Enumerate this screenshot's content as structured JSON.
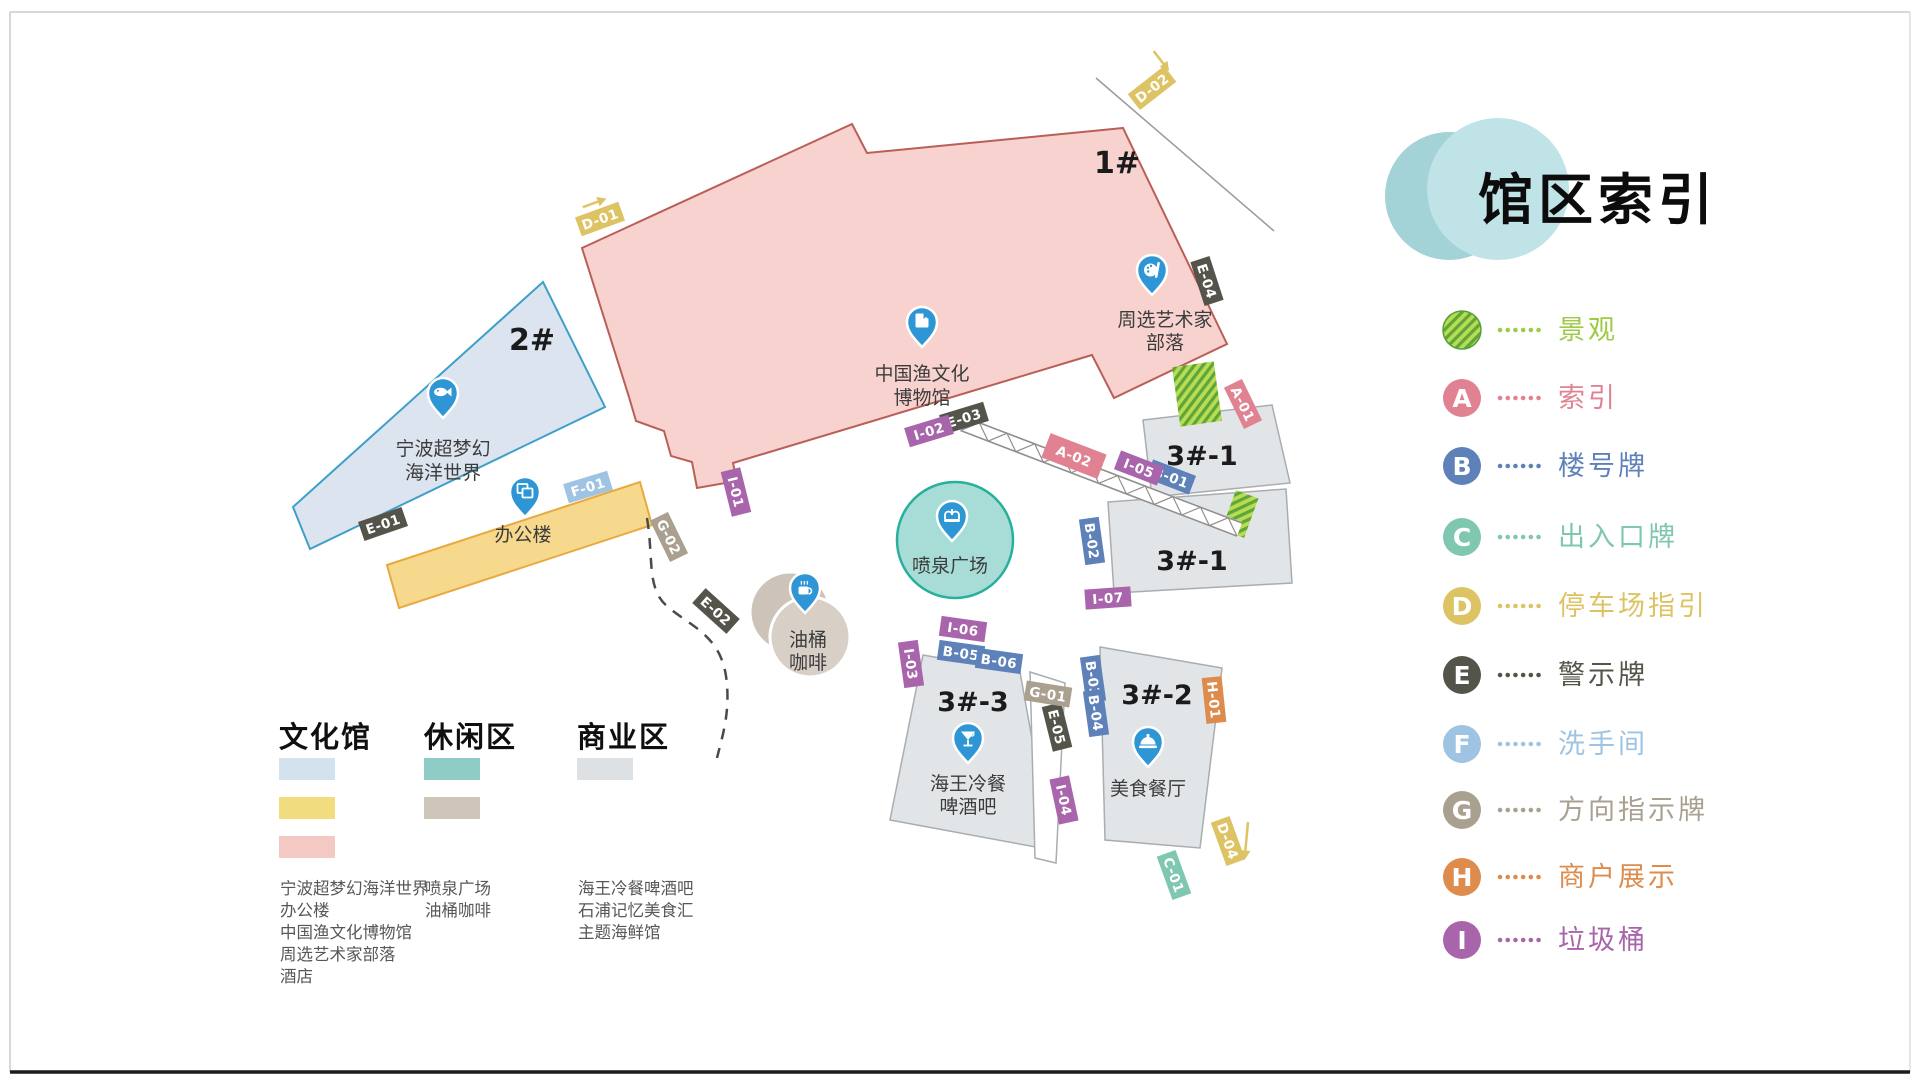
{
  "title": "馆区索引",
  "legend": {
    "items": [
      {
        "letter": "",
        "label": "景观",
        "color": "#9ecb45"
      },
      {
        "letter": "A",
        "label": "索引",
        "color": "#e08292"
      },
      {
        "letter": "B",
        "label": "楼号牌",
        "color": "#5e81ba"
      },
      {
        "letter": "C",
        "label": "出入口牌",
        "color": "#7fc7b0"
      },
      {
        "letter": "D",
        "label": "停车场指引",
        "color": "#ddc364"
      },
      {
        "letter": "E",
        "label": "警示牌",
        "color": "#55544a"
      },
      {
        "letter": "F",
        "label": "洗手间",
        "color": "#9fc3e3"
      },
      {
        "letter": "G",
        "label": "方向指示牌",
        "color": "#a9a090"
      },
      {
        "letter": "H",
        "label": "商户展示",
        "color": "#dd8c4d"
      },
      {
        "letter": "I",
        "label": "垃圾桶",
        "color": "#a965ab"
      }
    ]
  },
  "categories": [
    {
      "title": "文化馆",
      "swatches": [
        "#d4e2ee",
        "#f2dc80",
        "#f5c9c3"
      ],
      "items": [
        "宁波超梦幻海洋世界",
        "办公楼",
        "中国渔文化博物馆",
        "周选艺术家部落",
        "酒店"
      ]
    },
    {
      "title": "休闲区",
      "swatches": [
        "#8fccc6",
        "#cfc5b8"
      ],
      "items": [
        "喷泉广场",
        "油桶咖啡"
      ]
    },
    {
      "title": "商业区",
      "swatches": [
        "#dde1e3"
      ],
      "items": [
        "海王冷餐啤酒吧",
        "石浦记忆美食汇",
        "主题海鲜馆"
      ]
    }
  ],
  "map": {
    "buildings": {
      "b1": {
        "number": "1#",
        "name1": "中国渔文化",
        "name2": "博物馆",
        "artist1": "周选艺术家",
        "artist2": "部落"
      },
      "b2": {
        "number": "2#",
        "name1": "宁波超梦幻",
        "name2": "海洋世界"
      },
      "office": {
        "name": "办公楼"
      },
      "b31_up": {
        "number": "3#-1"
      },
      "b31_lo": {
        "number": "3#-1"
      },
      "b32": {
        "number": "3#-2",
        "name": "美食餐厅"
      },
      "b33": {
        "number": "3#-3",
        "name1": "海王冷餐",
        "name2": "啤酒吧"
      },
      "fountain": {
        "name": "喷泉广场"
      },
      "coffee": {
        "name1": "油桶",
        "name2": "咖啡"
      }
    },
    "tags": {
      "d01": "D-01",
      "d02": "D-02",
      "d04": "D-04",
      "a01": "A-01",
      "a02": "A-02",
      "b01": "B-01",
      "b02": "B-02",
      "b03": "B-03",
      "b04": "B-04",
      "b05": "B-05",
      "b06": "B-06",
      "c01": "C-01",
      "e01": "E-01",
      "e02": "E-02",
      "e03": "E-03",
      "e04": "E-04",
      "e05": "E-05",
      "f01": "F-01",
      "g01": "G-01",
      "g02": "G-02",
      "h01": "H-01",
      "i01": "I-01",
      "i02": "I-02",
      "i03": "I-03",
      "i04": "I-04",
      "i05": "I-05",
      "i06": "I-06",
      "i07": "I-07"
    },
    "colors": {
      "pin": "#2e96d4",
      "building_pink": "#f7d2ce",
      "building_pink_stroke": "#b95f57",
      "building_blue": "#dce5ef",
      "building_blue_stroke": "#3f9fca",
      "building_yellow": "#f7d98e",
      "building_yellow_stroke": "#e8a93f",
      "building_gray": "#e2e5e7",
      "building_gray_stroke": "#a9adb0",
      "fountain_fill": "#a7dcd7",
      "fountain_stroke": "#27b09b",
      "coffee_fill_1": "#cdc3b9",
      "coffee_fill_2": "#d8cfc7"
    }
  }
}
